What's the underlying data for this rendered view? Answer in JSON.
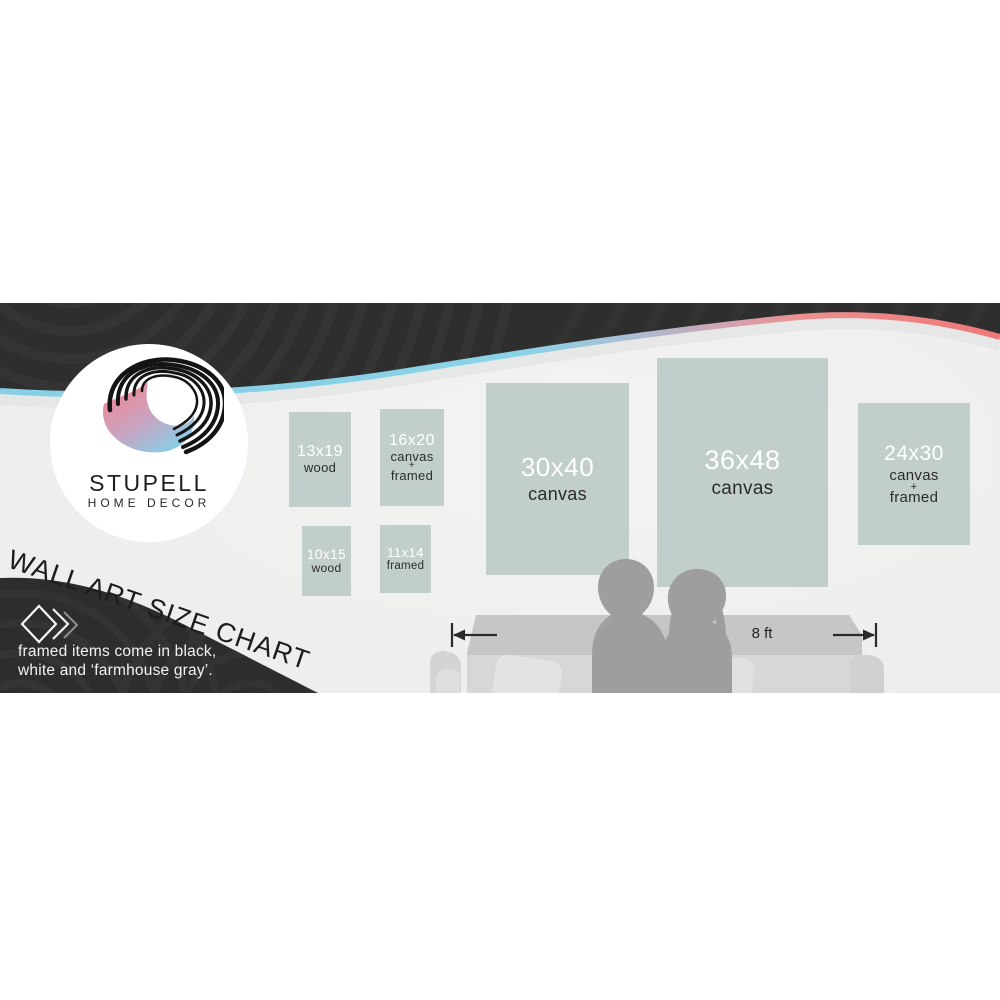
{
  "brand": {
    "name": "STUPELL",
    "tagline": "HOME DECOR"
  },
  "title": "WALL ART SIZE CHART",
  "note": {
    "line1": "framed items come in black,",
    "line2": "white and ‘farmhouse gray’."
  },
  "frames": [
    {
      "size": "13x19",
      "lines": [
        "wood"
      ]
    },
    {
      "size": "16x20",
      "lines": [
        "canvas",
        "+",
        "framed"
      ]
    },
    {
      "size": "10x15",
      "lines": [
        "wood"
      ]
    },
    {
      "size": "11x14",
      "lines": [
        "framed"
      ]
    },
    {
      "size": "30x40",
      "lines": [
        "canvas"
      ]
    },
    {
      "size": "36x48",
      "lines": [
        "canvas"
      ]
    },
    {
      "size": "24x30",
      "lines": [
        "canvas",
        "+",
        "framed"
      ]
    }
  ],
  "measurement": {
    "label": "8 ft"
  },
  "colors": {
    "band_dark": "#2e2e2e",
    "accent_blue": "#87d0e4",
    "accent_pink": "#ee7878",
    "frame_fill": "#c2cecb",
    "wall": "#efefee",
    "silhouette": "#9e9e9e"
  }
}
